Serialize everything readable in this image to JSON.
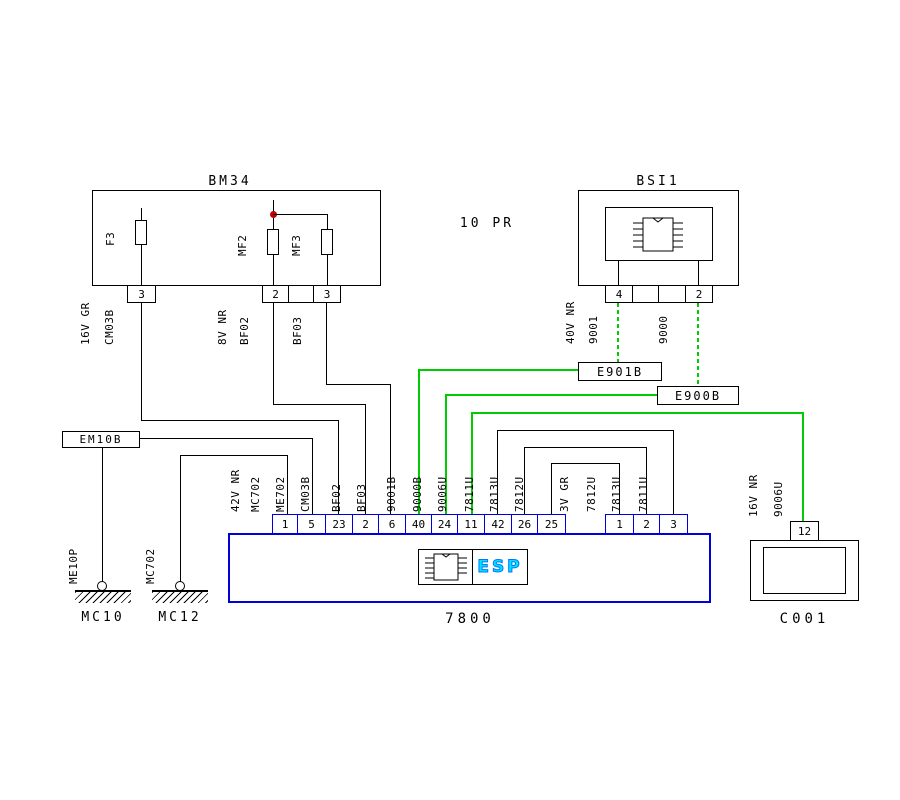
{
  "note": "10 PR",
  "bm34": {
    "title": "BM34",
    "fuses": {
      "f3": "F3",
      "mf2": "MF2",
      "mf3": "MF3"
    },
    "pins": {
      "f3": "3",
      "mf2": "2",
      "mf3": "3"
    },
    "wires": {
      "gauge1": "16V GR",
      "code1": "CM03B",
      "gauge2": "8V NR",
      "code2": "BF02",
      "code3": "BF03"
    }
  },
  "bsi1": {
    "title": "BSI1",
    "pins": {
      "a": "4",
      "b": "2"
    },
    "wires": {
      "gauge": "40V NR",
      "code_a": "9001",
      "code_b": "9000"
    }
  },
  "splices": {
    "e901b": "E901B",
    "e900b": "E900B",
    "em10b": "EM10B"
  },
  "grounds": {
    "g1_wire": "ME10P",
    "g1_name": "MC10",
    "g2_wire": "MC702",
    "g2_name": "MC12"
  },
  "esp": {
    "label": "ESP",
    "code": "7800",
    "conn_a_pins": [
      "1",
      "5",
      "23",
      "2",
      "6",
      "40",
      "24",
      "11",
      "42",
      "26",
      "25"
    ],
    "conn_a_labels": [
      "42V NR",
      "MC702",
      "ME702",
      "CM03B",
      "BF02",
      "BF03",
      "9001B",
      "9000B",
      "9006U",
      "7811U",
      "7813U",
      "7812U"
    ],
    "conn_b_pins": [
      "1",
      "2",
      "3"
    ],
    "conn_b_labels": [
      "3V GR",
      "7812U",
      "7813U",
      "7811U"
    ]
  },
  "c001": {
    "title": "C001",
    "pin": "12",
    "wire_gauge": "16V NR",
    "wire_code": "9006U"
  },
  "colors": {
    "wire_green": "#00CC00",
    "connector_blue": "#0000DD",
    "junction_red": "#C00000",
    "esp_text": "#00E5FF"
  }
}
